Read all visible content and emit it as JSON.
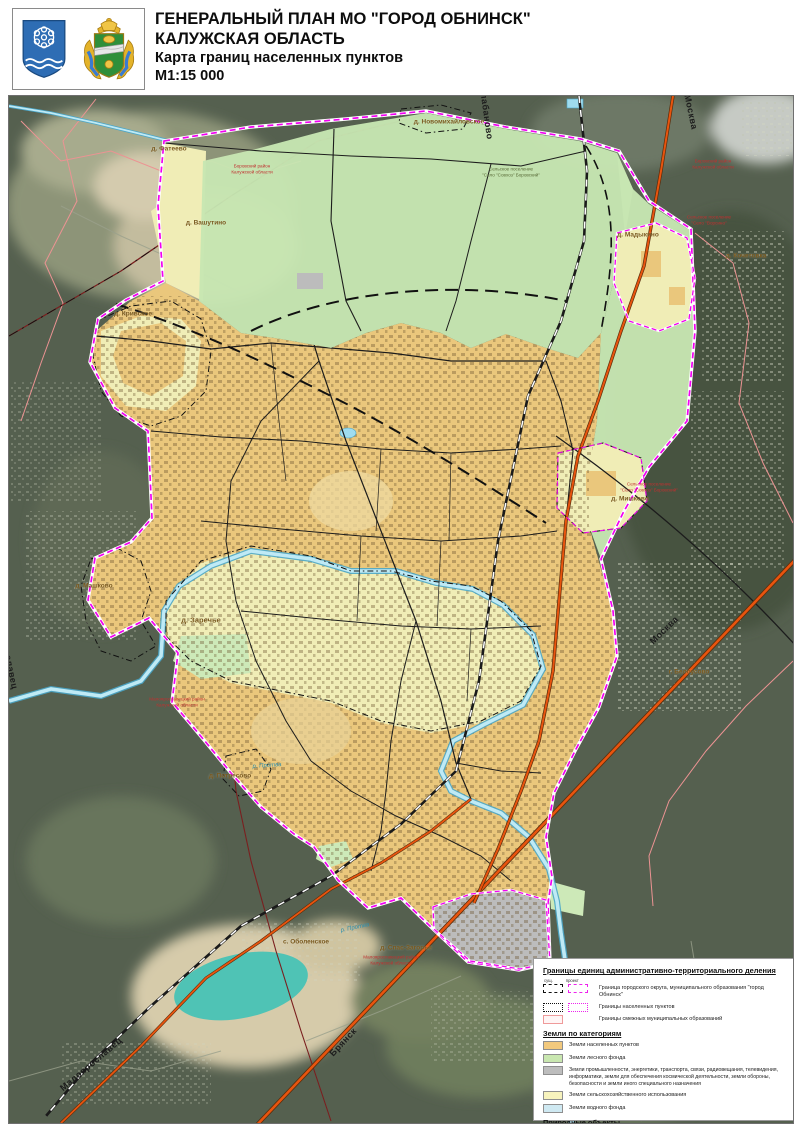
{
  "header": {
    "title_line1": "ГЕНЕРАЛЬНЫЙ ПЛАН МО \"ГОРОД ОБНИНСК\"",
    "title_line2": "КАЛУЖСКАЯ ОБЛАСТЬ",
    "subtitle": "Карта границ населенных пунктов",
    "scale": "М1:15 000"
  },
  "emblems": {
    "left": "герб города Обнинск",
    "right": "герб Калужской области"
  },
  "map": {
    "settlements": [
      {
        "name": "д. Фатеево"
      },
      {
        "name": "д. Новомихайловское"
      },
      {
        "name": "д. Вашутино"
      },
      {
        "name": "д. Мадыкино"
      },
      {
        "name": "д. Кочетовка"
      },
      {
        "name": "д. Кривское"
      },
      {
        "name": "д. Мишково"
      },
      {
        "name": "д. Машково"
      },
      {
        "name": "д. Заречье"
      },
      {
        "name": "д. Потресово"
      },
      {
        "name": "с. Оболенское"
      },
      {
        "name": "г. Белоусово"
      },
      {
        "name": "д. Спас-Загорье"
      }
    ],
    "road_labels": [
      {
        "name": "Москва"
      },
      {
        "name": "Москва"
      },
      {
        "name": "Брянск"
      },
      {
        "name": "Малоярославец"
      },
      {
        "name": "Балабаново"
      },
      {
        "name": "Малоярославец"
      }
    ],
    "river_labels": [
      {
        "name": "р. Протва"
      },
      {
        "name": "р. Протва"
      }
    ],
    "notes": [
      {
        "text": "Боровский район\nКалужской области"
      },
      {
        "text": "Сельское поселение\n\"Село \"Ворсино\""
      },
      {
        "text": "Боровский район\nКалужской области"
      },
      {
        "text": "Малоярославецкий район\nКалужской области"
      },
      {
        "text": "Малоярославецкий район\nКалужской области"
      },
      {
        "text": "Сельское поселение\n\"Село \"Совхоз\" Боровский\""
      },
      {
        "text": "Сельское поселение\n\"Село \"Совхоз\" Боровский\""
      }
    ]
  },
  "legend": {
    "boundaries_title": "Границы единиц административно-территориального деления",
    "col_existing": "сущ.",
    "col_project": "проект",
    "boundary_rows": [
      {
        "label": "Граница городского округа, муниципального образования \"город Обнинск\""
      },
      {
        "label": "Границы населенных пунктов"
      },
      {
        "label": "Границы смежных муниципальных образований"
      }
    ],
    "land_title": "Земли по категориям",
    "land_categories": [
      {
        "label": "Земли населенных пунктов",
        "color": "#f2c97d"
      },
      {
        "label": "Земли лесного фонда",
        "color": "#c9e7b0"
      },
      {
        "label": "Земли промышленности, энергетики, транспорта, связи, радиовещания, телевидения, информатики, земли для обеспечения космической деятельности, земли обороны, безопасности и земли иного специального назначения",
        "color": "#bdbdbd"
      },
      {
        "label": "Земли сельскохозяйственного использования",
        "color": "#f7f3bd"
      },
      {
        "label": "Земли водного фонда",
        "color": "#cfe9f2"
      }
    ],
    "natural_title": "Природные объекты",
    "natural_objects": [
      {
        "label": "Поверхностные водные объекты",
        "color": "#c5ecf5"
      }
    ]
  },
  "colors": {
    "boundary_magenta": "#f200f2",
    "highway_orange": "#e8540e",
    "urban_land": "#eac77c",
    "forest_land": "#c7e6b2",
    "industrial_land": "#bcbcbc",
    "agricultural_land": "#f0edb6",
    "water": "#bfeaf5",
    "satellite_base": "#55604f"
  }
}
